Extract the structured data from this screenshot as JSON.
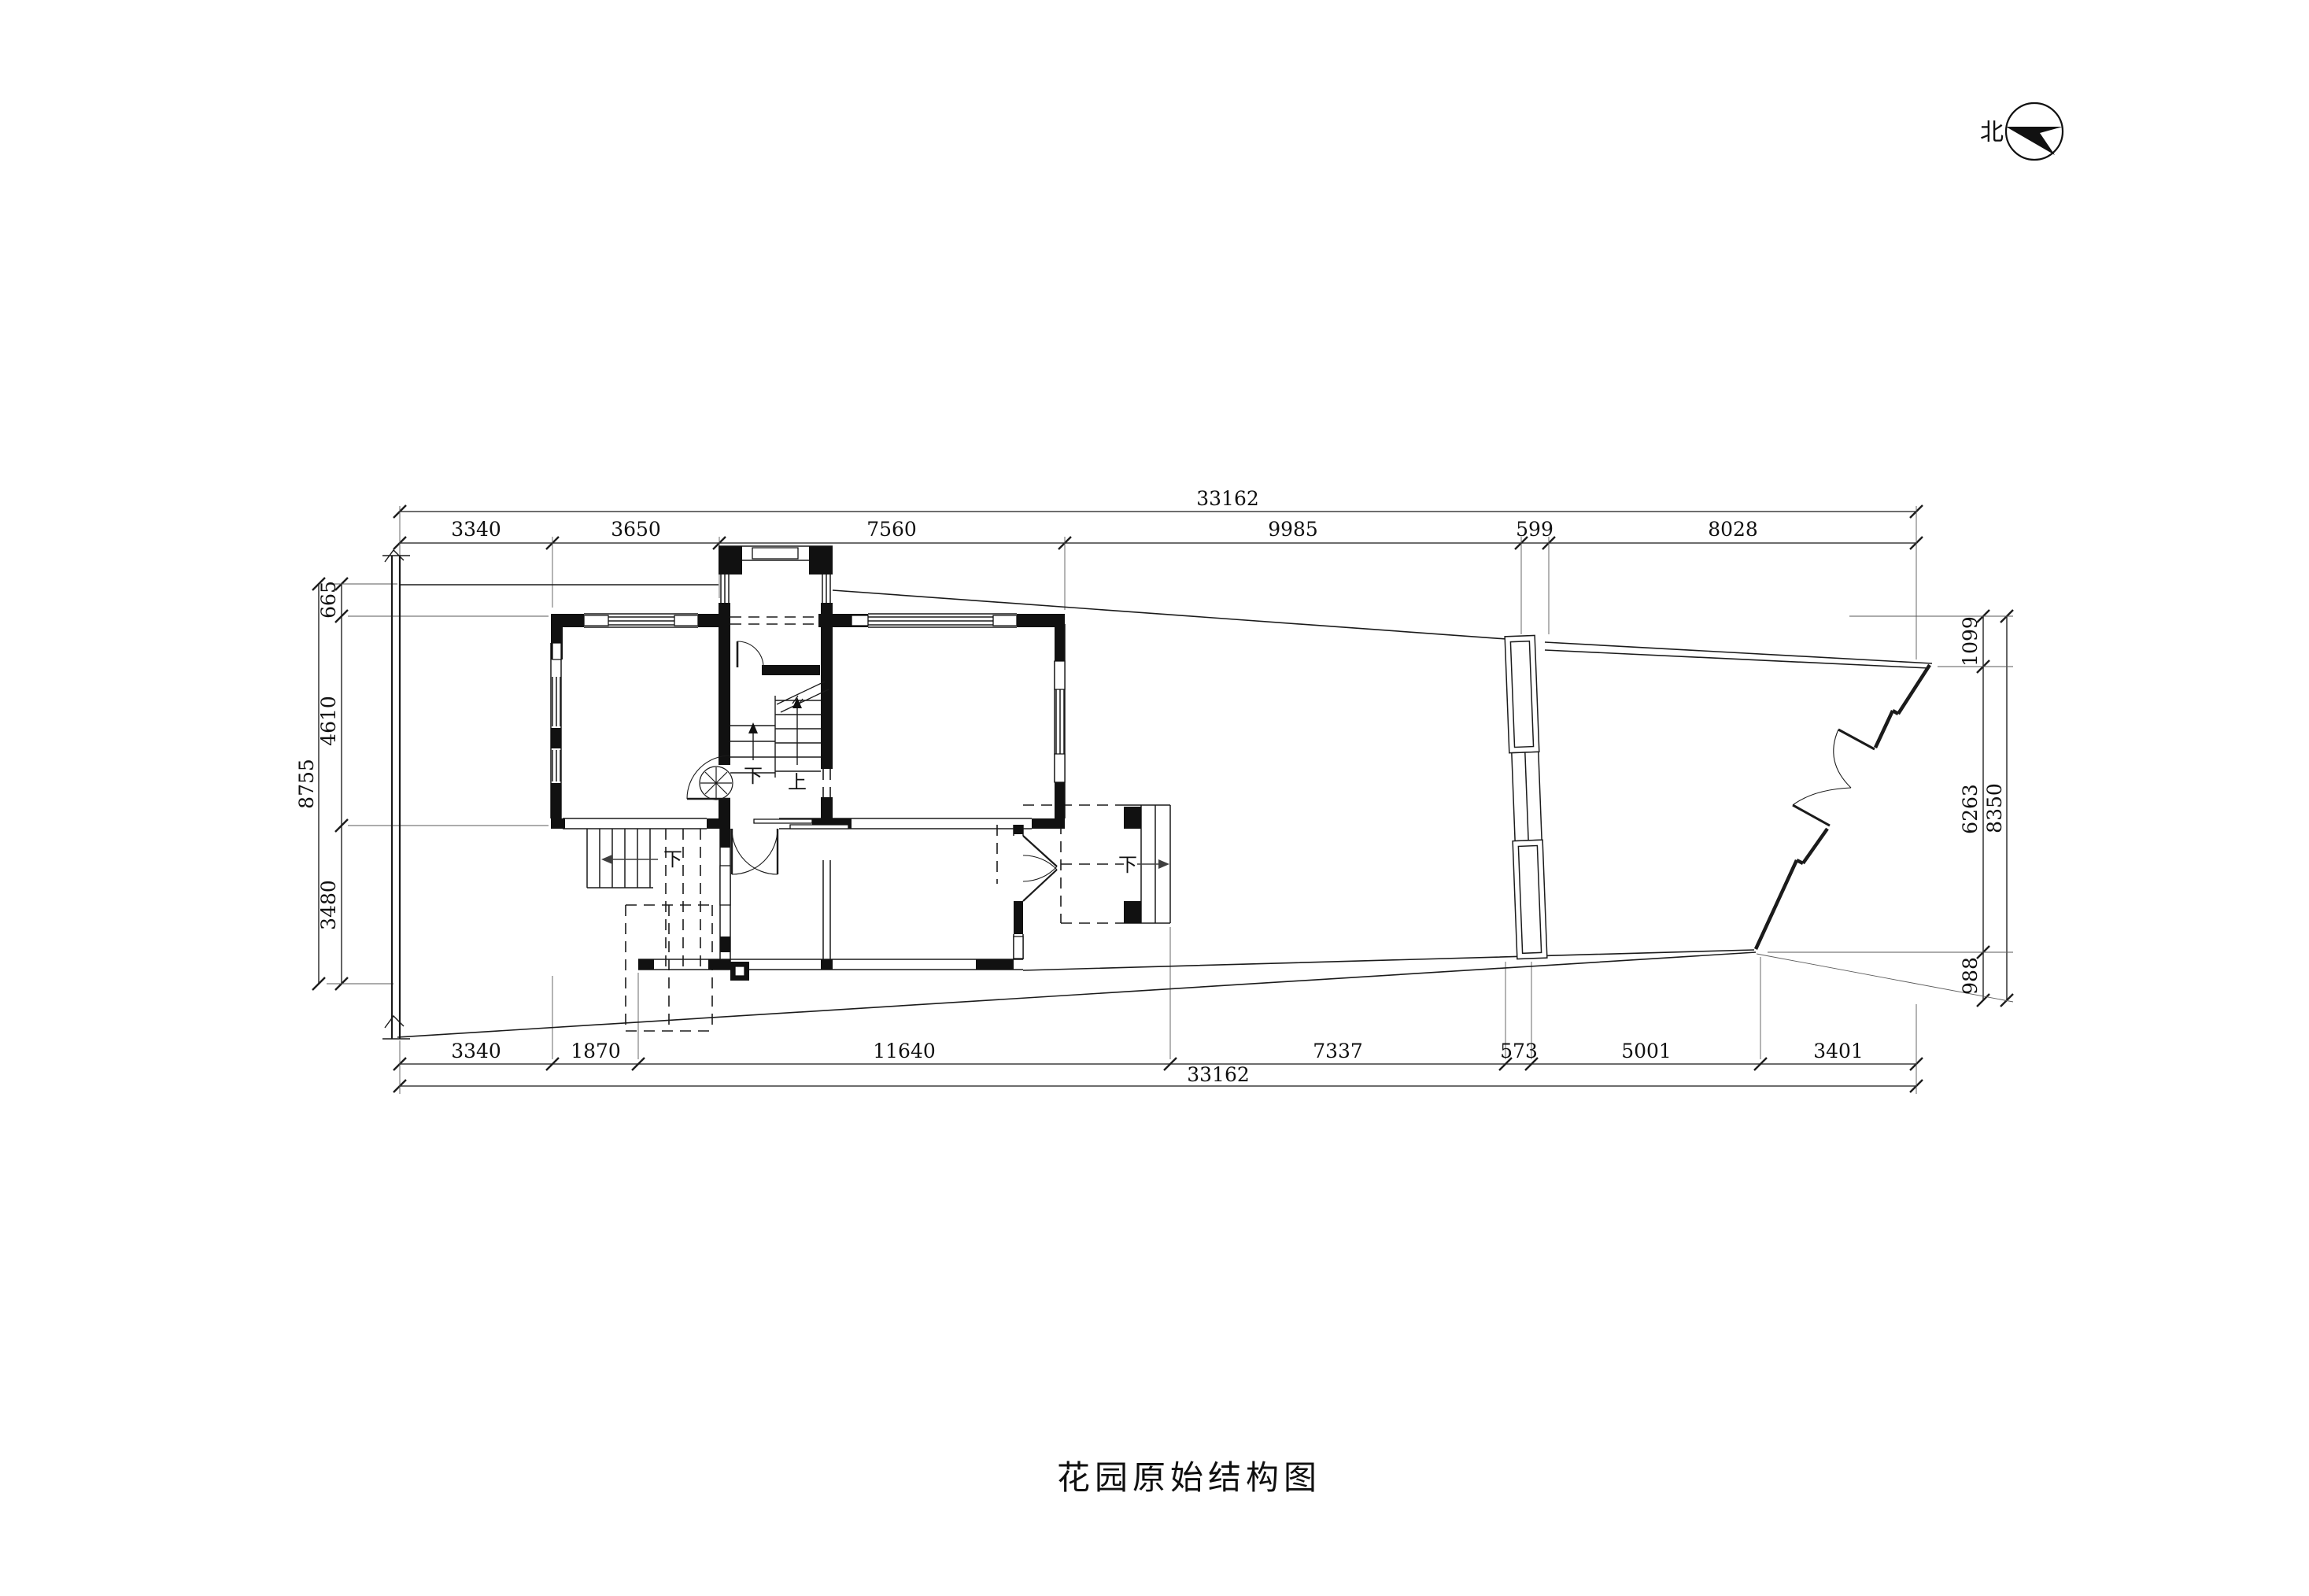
{
  "drawing": {
    "title": "花园原始结构图",
    "north_label": "北"
  },
  "dimensions": {
    "top": {
      "total": "33162",
      "segments": [
        "3340",
        "3650",
        "7560",
        "9985",
        "599",
        "8028"
      ]
    },
    "bottom": {
      "total": "33162",
      "segments": [
        "3340",
        "1870",
        "11640",
        "7337",
        "573",
        "5001",
        "3401"
      ]
    },
    "left": {
      "total": "8755",
      "segments": [
        "665",
        "4610",
        "3480"
      ]
    },
    "right": {
      "total": "8350",
      "segments": [
        "1099",
        "6263",
        "988"
      ]
    }
  },
  "plan_labels": {
    "stair_up": "上",
    "stair_down": "下",
    "exterior_stair_down": "下",
    "porch_step_down": "下"
  },
  "colors": {
    "line": "#1b1b1b",
    "dim_line": "#3f3f3f",
    "wall_fill": "#111111",
    "background": "#ffffff"
  }
}
